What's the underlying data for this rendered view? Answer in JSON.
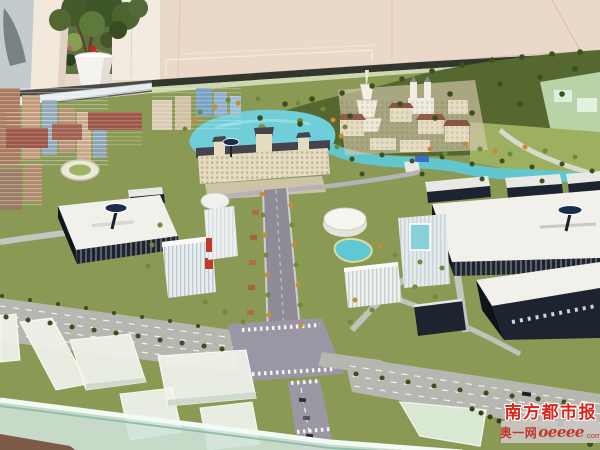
{
  "watermark": {
    "newspaper": "南方都市报",
    "site_prefix": "奥一网",
    "site_name": "oeeee",
    "site_tld": ".com"
  },
  "palette": {
    "wall": "#ead8c9",
    "pillar": "#f2e8dc",
    "grass": "#8a9a55",
    "forest": "#55682f",
    "lake": "#6fced8",
    "river": "#62c6cf",
    "road": "#b7b7b1",
    "boulevard": "#8e8a96",
    "factoryWall": "#1d2430",
    "roofWhite": "#f2f0ea",
    "cream": "#e6dcc2",
    "brick": "#9c584a",
    "blockWhite": "#eff3ea",
    "glassFace": "#cfe3d8",
    "glassLine": "#8fc0ac",
    "woodBrown": "#7b5a47",
    "logoNavy": "#1b2b4c",
    "treeOrange": "#c98a3c",
    "treeGreen": "#6f8a3e",
    "treeDark": "#3c4f20",
    "wmRed": "#d8281c",
    "wmRed2": "#c03828",
    "wmBand": "rgba(203,199,196,0.92)"
  }
}
